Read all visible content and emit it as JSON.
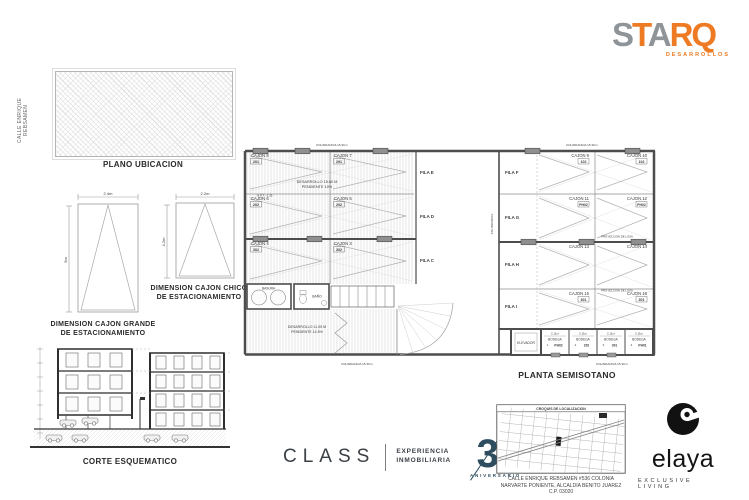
{
  "logos": {
    "starq": {
      "letters": [
        "S",
        "T",
        "A",
        "R",
        "Q"
      ],
      "tagline": "DESARROLLOS",
      "orange": "#ee7a23",
      "gray": "#8e9497"
    },
    "class": {
      "name": "CLASS",
      "tagline_line1": "EXPERIENCIA",
      "tagline_line2": "INMOBILIARIA",
      "anniversary_number": "30",
      "anniversary_label": "ANIVERSARIO",
      "color": "#2e4d5f"
    },
    "elaya": {
      "name": "elaya",
      "tagline": "EXCLUSIVE LIVING"
    }
  },
  "location_plan": {
    "street": "CALLE ENRIQUE REBSAMEN",
    "title": "PLANO UBICACION"
  },
  "parking": {
    "large": {
      "title1": "DIMENSION CAJON GRANDE",
      "title2": "DE ESTACIONAMIENTO",
      "width": "2.4m",
      "depth": "5m"
    },
    "small": {
      "title1": "DIMENSION CAJON CHICO",
      "title2": "DE ESTACIONAMIENTO",
      "width": "2.2m",
      "depth": "4.2m"
    }
  },
  "section_view": {
    "title": "CORTE ESQUEMATICO"
  },
  "floor_plan": {
    "title": "PLANTA SEMISOTANO",
    "ramp_upper1": "DESARROLLO 15.60 M",
    "ramp_upper2": "PENDIENTE 10%",
    "ramp_lower1": "DESARROLLO 11.05 M",
    "ramp_lower2": "PENDIENTE 14.5%",
    "level_note": "N.P.T. -1.35",
    "boundary_note": "COLINDANCIA 15.30 m",
    "lot_note": "COLINDANCIA",
    "slab_note": "PROYECCION DE LOSA",
    "rows_left": [
      "FILA E",
      "FILA D",
      "FILA C"
    ],
    "rows_right": [
      "FILA F",
      "FILA G",
      "FILA H",
      "FILA I"
    ],
    "stalls": [
      {
        "label": "CAJON 8",
        "unit": "201"
      },
      {
        "label": "CAJON 7",
        "unit": "201"
      },
      {
        "label": "CAJON 6",
        "unit": "202"
      },
      {
        "label": "CAJON 5",
        "unit": "202"
      },
      {
        "label": "CAJON 4",
        "unit": "302"
      },
      {
        "label": "CAJON 3",
        "unit": "302"
      },
      {
        "label": "CAJON 9",
        "unit": "102"
      },
      {
        "label": "CAJON 10",
        "unit": "102"
      },
      {
        "label": "CAJON 11",
        "unit": "PH02"
      },
      {
        "label": "CAJON 12",
        "unit": "PH02"
      },
      {
        "label": "CAJON 13",
        "unit": ""
      },
      {
        "label": "CAJON 14",
        "unit": ""
      },
      {
        "label": "CAJON 15",
        "unit": "301"
      },
      {
        "label": "CAJON 16",
        "unit": "301"
      }
    ],
    "rooms": {
      "trash": "BASURA",
      "bath": "BAÑO",
      "elevator": "ELEVADOR"
    },
    "storage_dim": "2.11m",
    "storages": [
      {
        "label": "BODEGA",
        "num": "1",
        "unit": "PH02"
      },
      {
        "label": "BODEGA",
        "num": "2",
        "unit": "202"
      },
      {
        "label": "BODEGA",
        "num": "3",
        "unit": "301"
      },
      {
        "label": "BODEGA",
        "num": "4",
        "unit": "PH01"
      }
    ]
  },
  "map": {
    "title": "CROQUIS DE LOCALIZACION",
    "address1": "CALLE ENRIQUE REBSAMEN #536 COLONIA",
    "address2": "NARVARTE PONIENTE, ALCALDIA BENITO JUAREZ",
    "address3": "C.P. 03020"
  }
}
